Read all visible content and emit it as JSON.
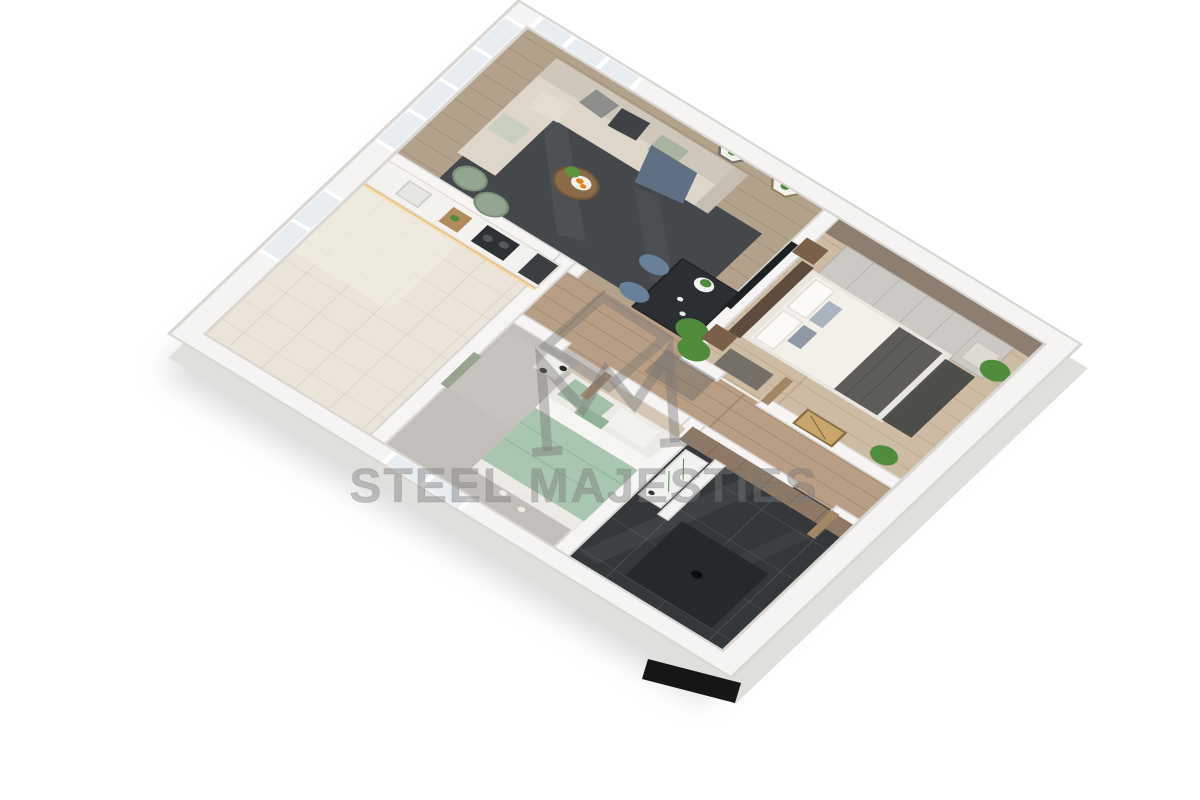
{
  "watermark": {
    "brand_text": "STEEL MAJESTIES",
    "logo": "diamond-m-monogram-icon",
    "text_color": "#7a7a7a",
    "opacity": 0.42
  },
  "scene": {
    "title": "3D isometric cutaway floor plan render of an apartment",
    "background": "#ffffff",
    "view": "top-down isometric dollhouse"
  },
  "rooms": [
    {
      "id": "living-room",
      "label": "Living room with L-shaped beige sofa, charcoal rug, round coffee table with fruit plate, dining table with blue chairs, balcony glass walls and hexagonal wall shelves",
      "floor": "#b2a28c"
    },
    {
      "id": "kitchen",
      "label": "Kitchen with cream tile floor, white counter with warm LED strip, hob, cutting board and window",
      "floor": "#eae4d9"
    },
    {
      "id": "master-bedroom",
      "label": "Master bedroom with double bed, taupe accent wall, light gray wardrobe, nightstands and potted plants",
      "floor": "#cdbba3"
    },
    {
      "id": "second-bedroom",
      "label": "Second bedroom with sage green bedding, pendant lights, wall niche shelf, floor candles and window",
      "floor": "#c2bfbb"
    },
    {
      "id": "bathroom",
      "label": "Bathroom with dark gloss tiles, shower partition, vanity with greenery and wood accent wall",
      "floor": "#34383b"
    },
    {
      "id": "hallway",
      "label": "Hallway with wood plank floor, golden palm artwork and doors to bedrooms and bathroom",
      "floor": "#b79e84"
    }
  ],
  "palette": {
    "background": "#ffffff",
    "watermark_gray": "#7a7a7a",
    "wall_white": "#f5f4f2",
    "wood_light": "#cdbba3",
    "wood_hall": "#b79e84",
    "rug_charcoal": "#45484b",
    "kitchen_tile": "#eae4d9",
    "bath_tile": "#34383b",
    "sofa_beige": "#d6cfc2",
    "bed_green": "#a9c6b0",
    "accent_taupe": "#8e7e70",
    "plant_green": "#4e8c3c",
    "chair_blue": "#68809a",
    "led_warm": "#f0c078",
    "orange_fruit": "#e2821d"
  }
}
